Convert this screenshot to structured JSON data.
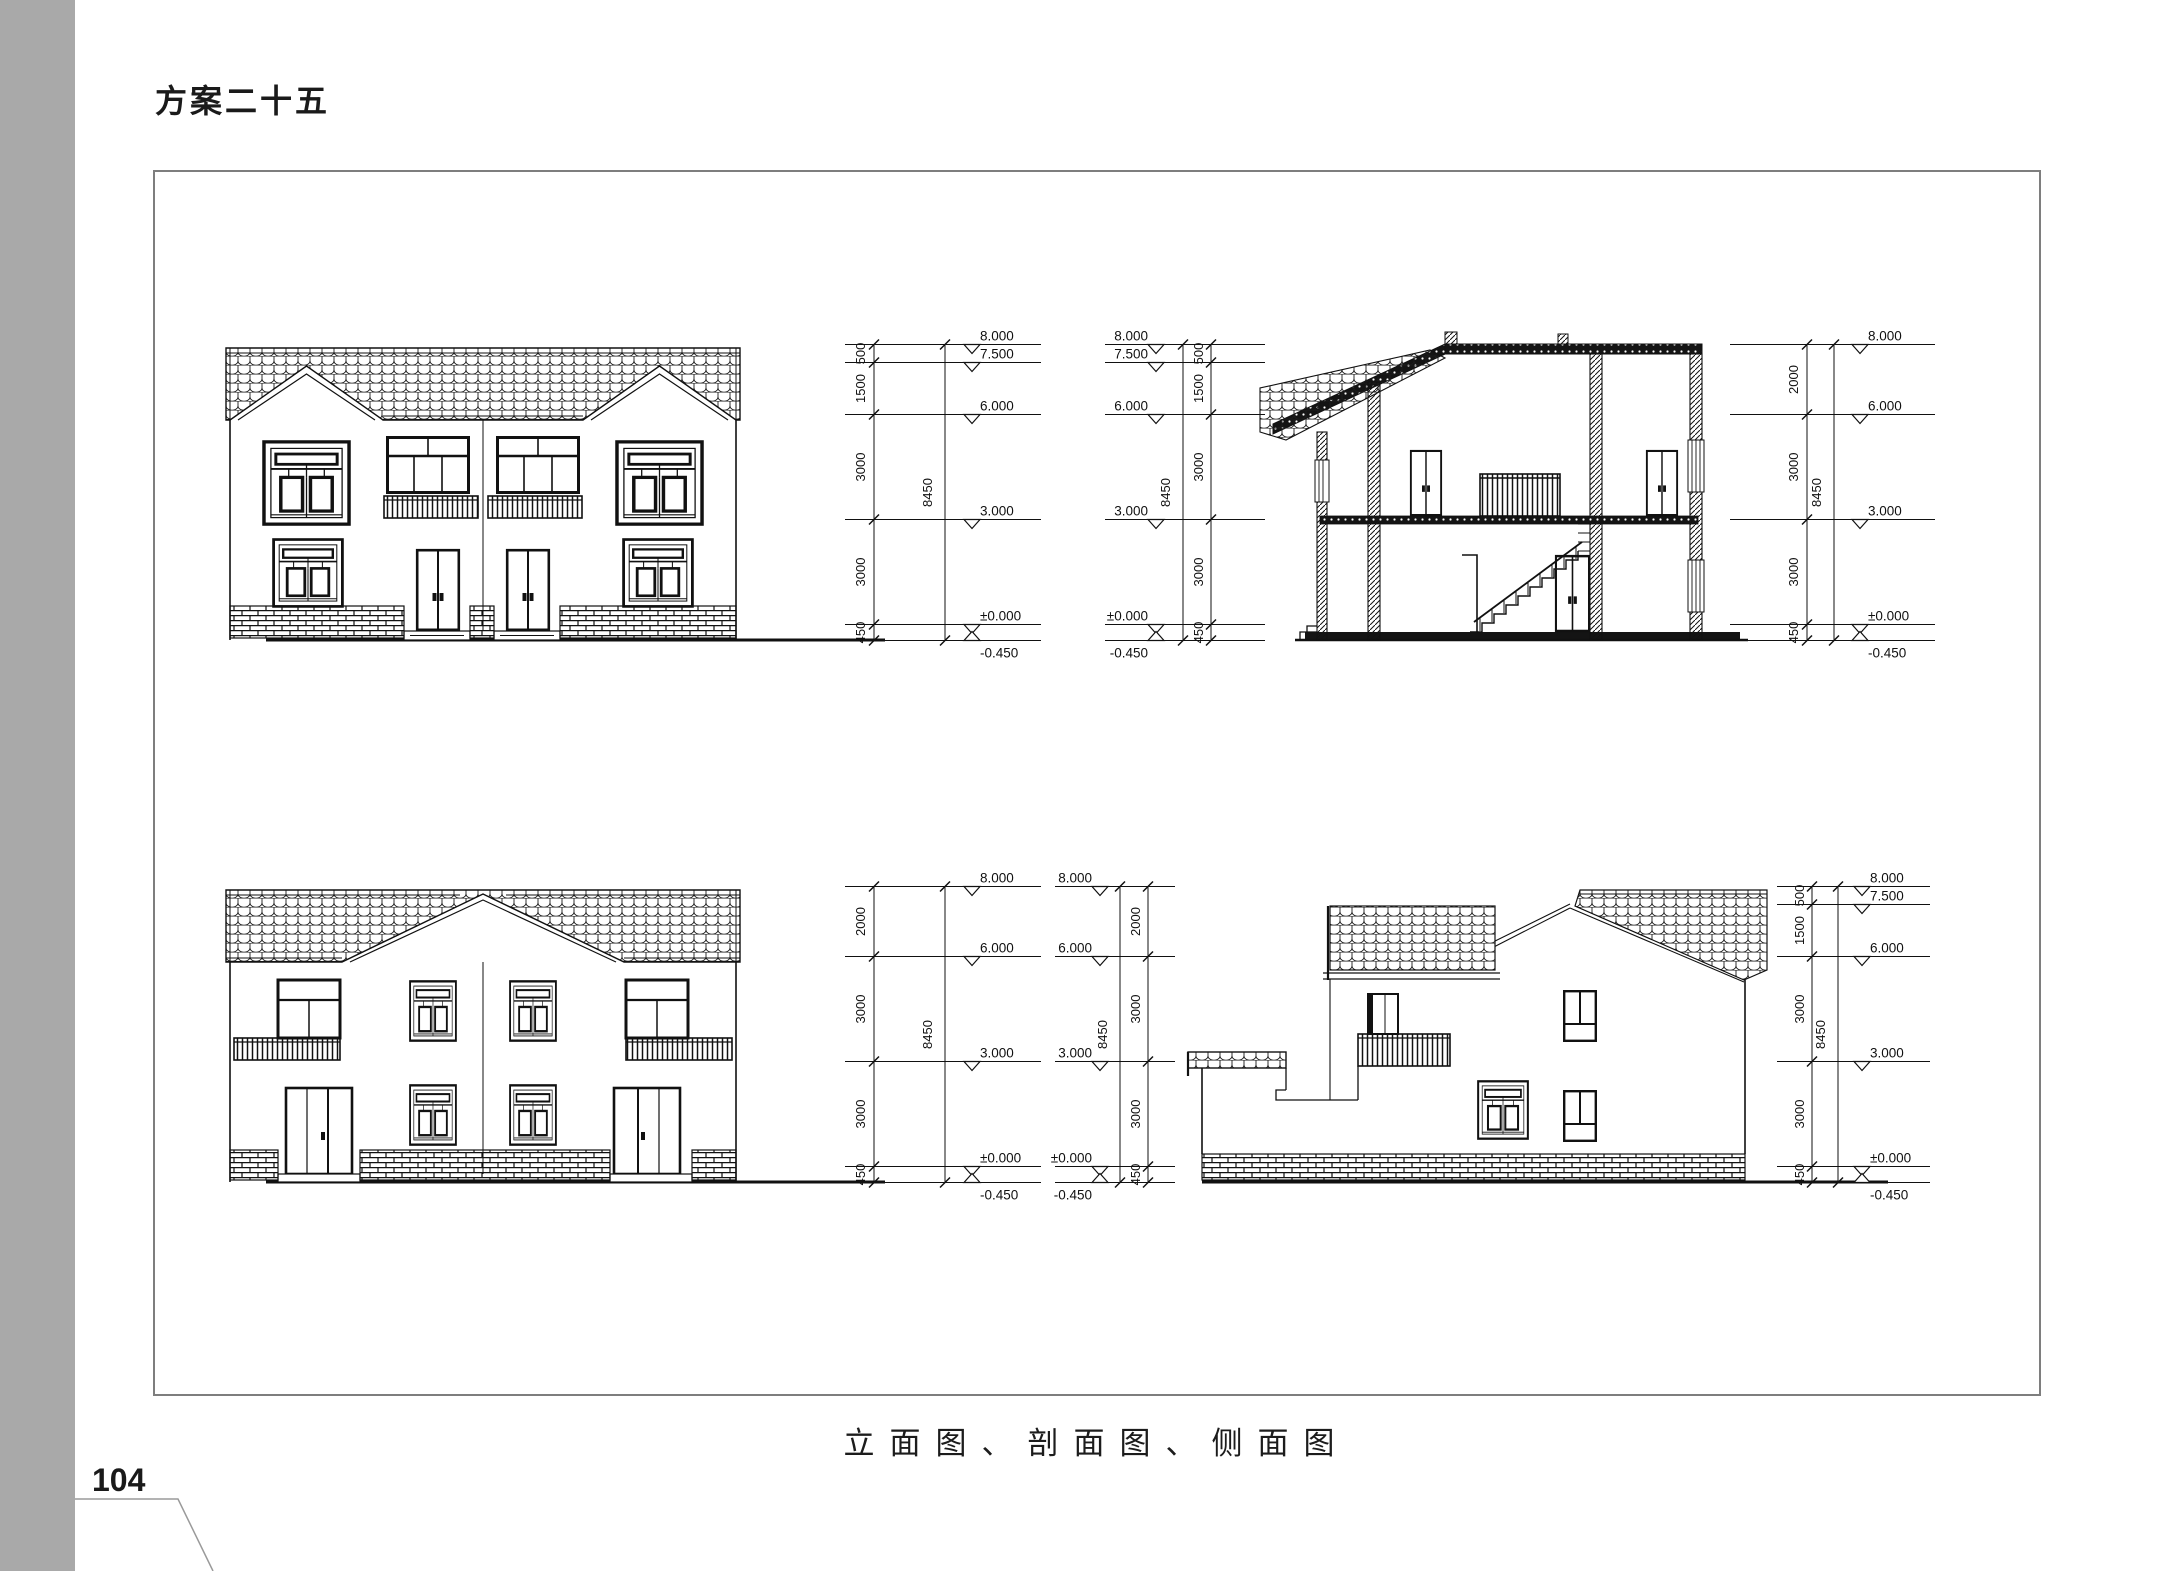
{
  "page": {
    "title": "方案二十五",
    "caption": "立面图、剖面图、侧面图",
    "page_number": "104"
  },
  "colors": {
    "sidebar_gray": "#a9a9a9",
    "frame_border_gray": "#7e7e7e",
    "ink": "#111111"
  },
  "drawings": {
    "front_elevation": {
      "dim_right": {
        "levels": [
          {
            "label": "8.000",
            "value": 8.0
          },
          {
            "label": "7.500",
            "value": 7.5
          },
          {
            "label": "6.000",
            "value": 6.0
          },
          {
            "label": "3.000",
            "value": 3.0
          },
          {
            "label": "±0.000",
            "value": 0.0
          },
          {
            "label": "-0.450",
            "value": -0.45
          }
        ],
        "segments": [
          "500",
          "1500",
          "3000",
          "3000",
          "450"
        ],
        "total": "8450"
      }
    },
    "section": {
      "dim_left": {
        "levels": [
          {
            "label": "8.000",
            "value": 8.0
          },
          {
            "label": "7.500",
            "value": 7.5
          },
          {
            "label": "6.000",
            "value": 6.0
          },
          {
            "label": "3.000",
            "value": 3.0
          },
          {
            "label": "±0.000",
            "value": 0.0
          },
          {
            "label": "-0.450",
            "value": -0.45
          }
        ],
        "segments": [
          "500",
          "1500",
          "3000",
          "3000",
          "450"
        ],
        "total": "8450"
      },
      "dim_right": {
        "levels": [
          {
            "label": "8.000",
            "value": 8.0
          },
          {
            "label": "6.000",
            "value": 6.0
          },
          {
            "label": "3.000",
            "value": 3.0
          },
          {
            "label": "±0.000",
            "value": 0.0
          },
          {
            "label": "-0.450",
            "value": -0.45
          }
        ],
        "segments": [
          "2000",
          "3000",
          "3000",
          "450"
        ],
        "total": "8450"
      }
    },
    "rear_elevation": {
      "dim_right": {
        "levels": [
          {
            "label": "8.000",
            "value": 8.0
          },
          {
            "label": "6.000",
            "value": 6.0
          },
          {
            "label": "3.000",
            "value": 3.0
          },
          {
            "label": "±0.000",
            "value": 0.0
          },
          {
            "label": "-0.450",
            "value": -0.45
          }
        ],
        "segments": [
          "2000",
          "3000",
          "3000",
          "450"
        ],
        "total": "8450"
      }
    },
    "side_elevation": {
      "dim_left": {
        "levels": [
          {
            "label": "8.000",
            "value": 8.0
          },
          {
            "label": "6.000",
            "value": 6.0
          },
          {
            "label": "3.000",
            "value": 3.0
          },
          {
            "label": "±0.000",
            "value": 0.0
          },
          {
            "label": "-0.450",
            "value": -0.45
          }
        ],
        "segments": [
          "2000",
          "3000",
          "3000",
          "450"
        ],
        "total": "8450"
      },
      "dim_right": {
        "levels": [
          {
            "label": "8.000",
            "value": 8.0
          },
          {
            "label": "7.500",
            "value": 7.5
          },
          {
            "label": "6.000",
            "value": 6.0
          },
          {
            "label": "3.000",
            "value": 3.0
          },
          {
            "label": "±0.000",
            "value": 0.0
          },
          {
            "label": "-0.450",
            "value": -0.45
          }
        ],
        "segments": [
          "500",
          "1500",
          "3000",
          "3000",
          "450"
        ],
        "total": "8450"
      }
    }
  }
}
